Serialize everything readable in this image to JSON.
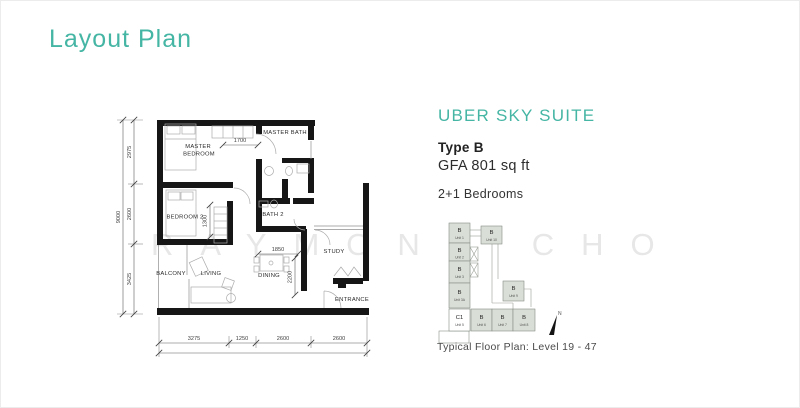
{
  "page": {
    "title": "Layout Plan",
    "watermark": "RAYMOND CHO"
  },
  "info": {
    "project": "UBER SKY SUITE",
    "type": "Type B",
    "gfa": "GFA 801 sq ft",
    "bedrooms": "2+1 Bedrooms"
  },
  "floor_plan": {
    "rooms": {
      "master_bedroom": [
        "MASTER",
        "BEDROOM"
      ],
      "master_bath": "MASTER BATH",
      "bedroom2": "BEDROOM 2",
      "bath2": "BATH 2",
      "balcony": "BALCONY",
      "living": "LIVING",
      "dining": "DINING",
      "study": "STUDY",
      "entrance": "ENTRANCE"
    },
    "dims": {
      "top": "1700",
      "wardrobe": "1300",
      "dining_width": "1850",
      "dining_depth": "2200",
      "left_total": "9000",
      "left_segments": [
        "2975",
        "2600",
        "3425"
      ],
      "bottom_segments": [
        "3275",
        "1250",
        "2600",
        "2600"
      ]
    }
  },
  "key_plan": {
    "units": [
      {
        "type": "B",
        "unit": "Unit 1"
      },
      {
        "type": "B",
        "unit": "Unit 10"
      },
      {
        "type": "B",
        "unit": "Unit 2"
      },
      {
        "type": "B",
        "unit": "Unit 3"
      },
      {
        "type": "B",
        "unit": "Unit 3A"
      },
      {
        "type": "B",
        "unit": "Unit 9"
      },
      {
        "type": "C1",
        "unit": "Unit 5"
      },
      {
        "type": "B",
        "unit": "Unit 6"
      },
      {
        "type": "B",
        "unit": "Unit 7"
      },
      {
        "type": "B",
        "unit": "Unit 8"
      }
    ],
    "north_label": "N",
    "caption": "Typical Floor Plan: Level 19 - 47"
  },
  "colors": {
    "accent": "#45b5a4",
    "wall": "#161616",
    "unit_fill": "#d9ded6",
    "watermark": "#e7e7e7"
  }
}
